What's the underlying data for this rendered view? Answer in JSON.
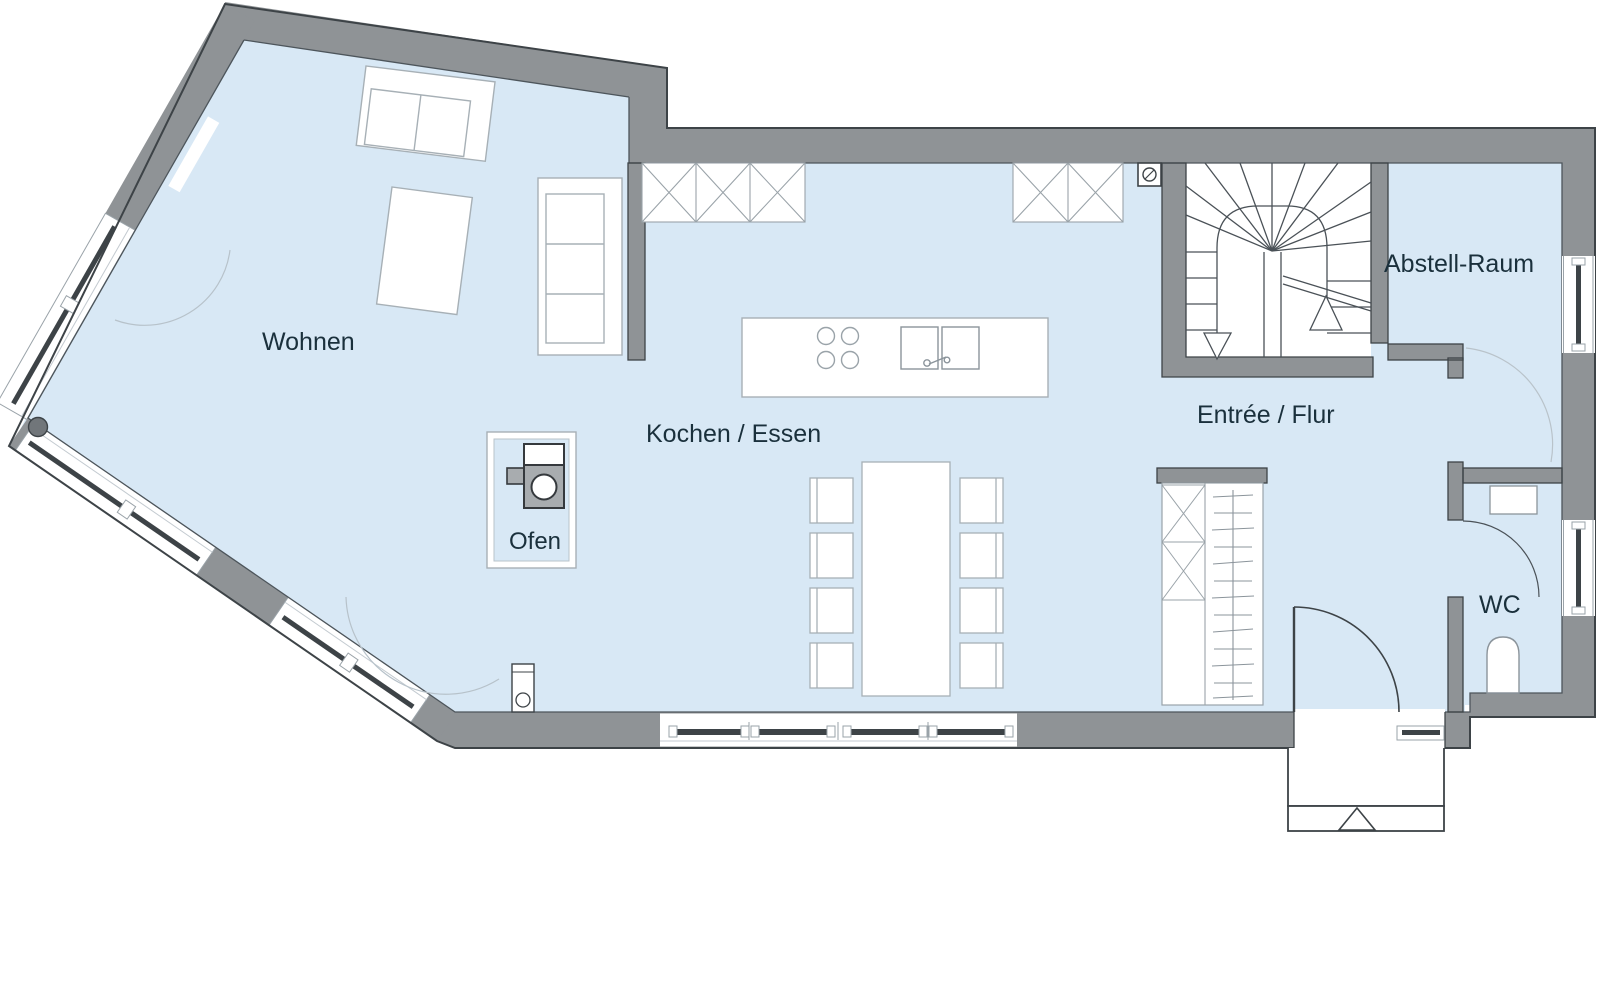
{
  "floorplan": {
    "rooms": {
      "wohnen": {
        "label": "Wohnen"
      },
      "kochen": {
        "label": "Kochen / Essen"
      },
      "ofen": {
        "label": "Ofen"
      },
      "entree": {
        "label": "Entrée / Flur"
      },
      "abstell": {
        "label": "Abstell-Raum"
      },
      "wc": {
        "label": "WC"
      }
    },
    "colors": {
      "wall_gray": "#8f9396",
      "floor_blue": "#d8e8f5",
      "outline_dark": "#3d4347",
      "furniture_outline": "#a7b0b6",
      "label_text": "#1a303c",
      "appliance_gray": "#a8acaf"
    }
  }
}
